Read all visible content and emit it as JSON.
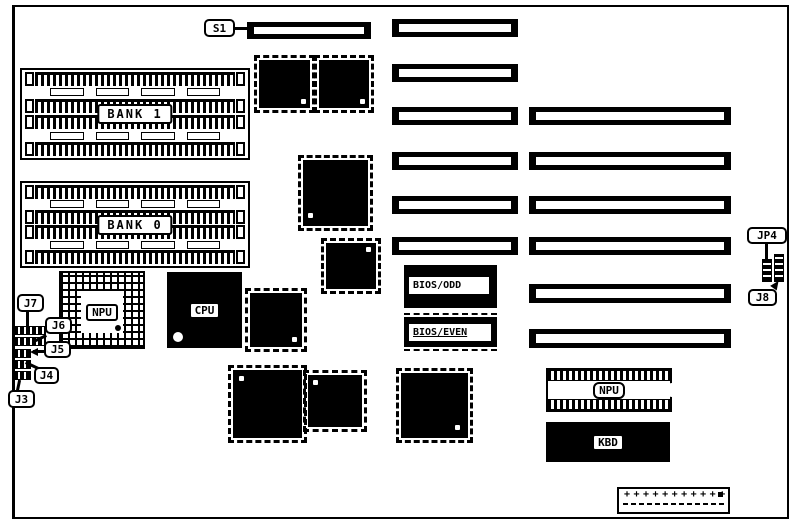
{
  "board": {
    "switch_label": "S1",
    "memory_banks": [
      {
        "label": "BANK 1"
      },
      {
        "label": "BANK 0"
      }
    ],
    "chips": {
      "npu_socket": "NPU",
      "cpu": "CPU",
      "bios_odd": "BIOS/ODD",
      "bios_even": "BIOS/EVEN",
      "npu_dip": "NPU",
      "kbd": "KBD"
    },
    "jumpers": {
      "jp4": "JP4",
      "j8": "J8",
      "j7": "J7",
      "j6": "J6",
      "j5": "J5",
      "j4": "J4",
      "j3": "J3"
    },
    "power_connector": {
      "pins": "+++++++++++"
    },
    "colors": {
      "ink": "#000000",
      "paper": "#ffffff"
    }
  }
}
